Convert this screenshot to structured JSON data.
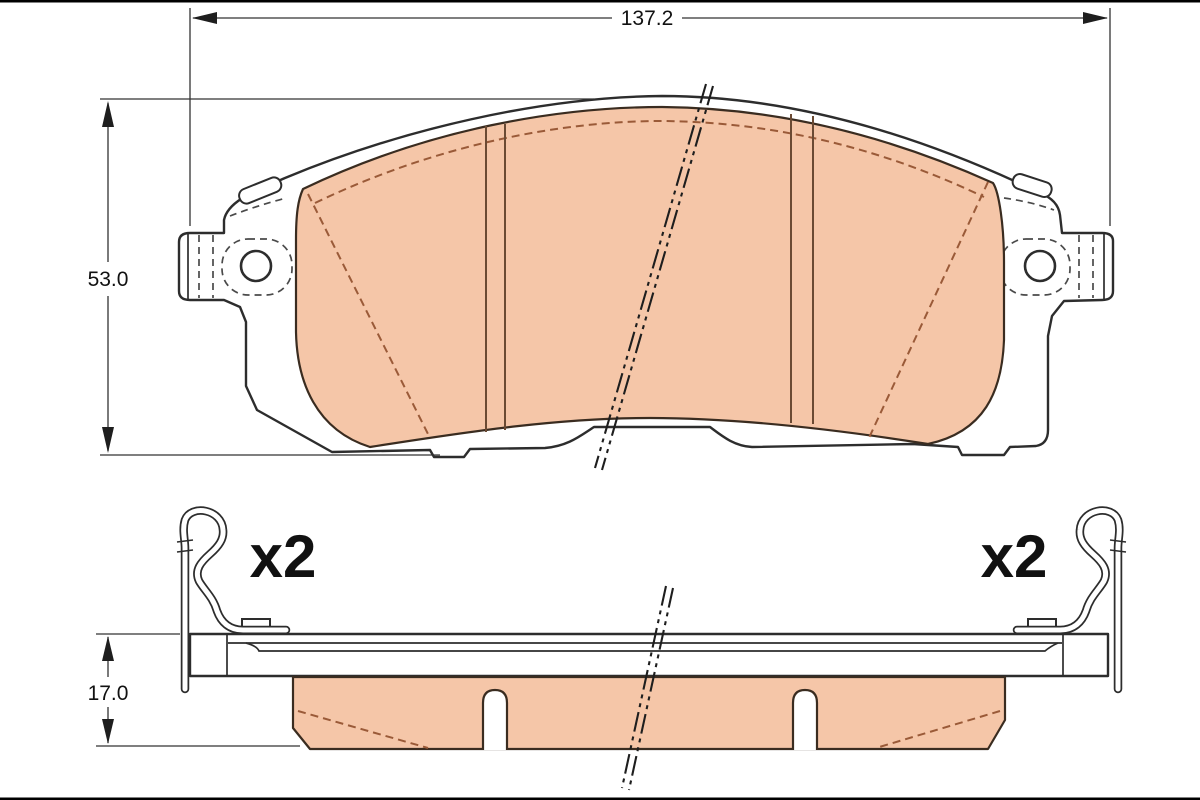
{
  "dimensions": {
    "width": "137.2",
    "height": "53.0",
    "thickness": "17.0"
  },
  "quantity": {
    "left_label": "x2",
    "right_label": "x2"
  },
  "colors": {
    "friction_material": "#f5c6a8",
    "outline": "#2d2d2d",
    "chamfer_line": "#9a5a38",
    "background": "#ffffff",
    "frame_border": "#000000"
  }
}
